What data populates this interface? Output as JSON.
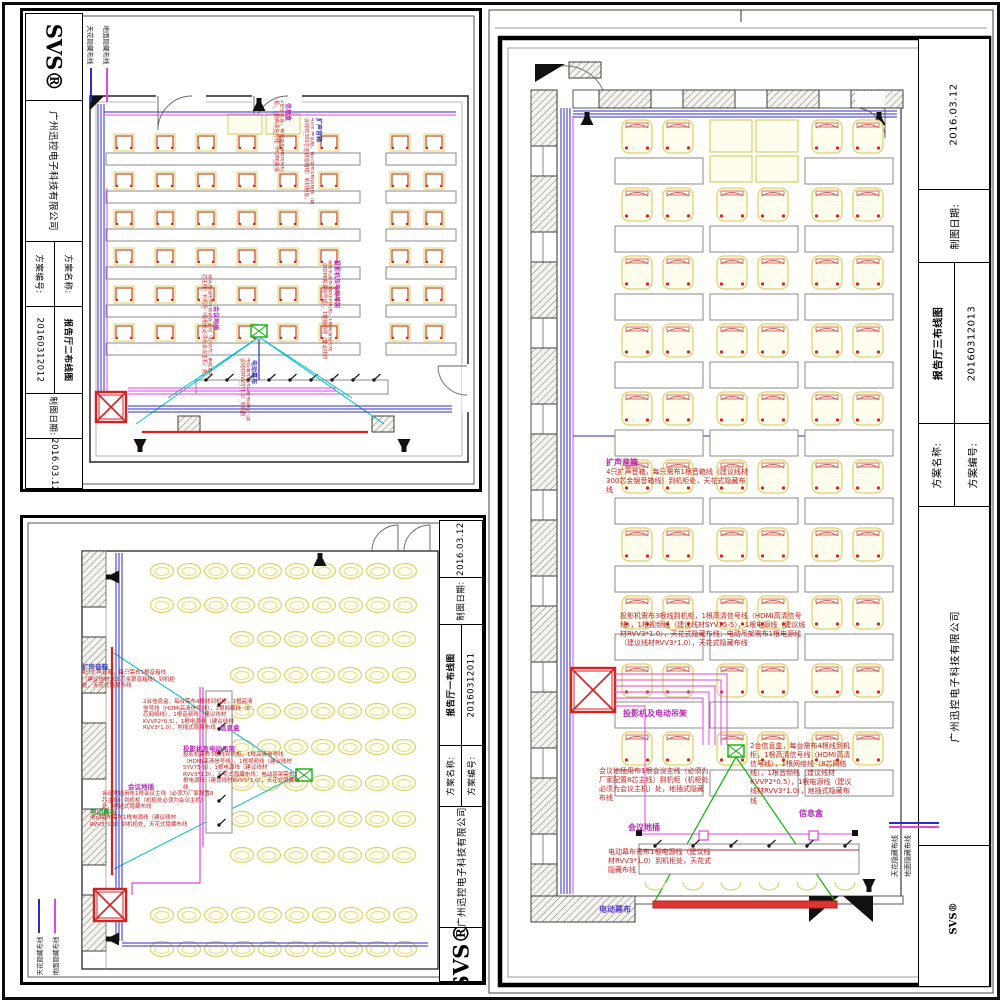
{
  "branding": {
    "logo": "SVS®",
    "company": "广州迅控电子科技有限公司"
  },
  "titleblock": {
    "name_label": "方案名称:",
    "number_label": "方案编号:",
    "date_label": "制图日期:",
    "date": "2016.03.12"
  },
  "legend": {
    "ceiling_label": "天花隐藏布线",
    "floor_label": "地面隐藏布线",
    "ceiling_color": "#2b2bc8",
    "floor_color": "#e046e0"
  },
  "sheets": [
    {
      "id": "hall2",
      "title": "报告厅二布线图",
      "number": "20160312012"
    },
    {
      "id": "hall1",
      "title": "报告厅一布线图",
      "number": "20160312011"
    },
    {
      "id": "hall3",
      "title": "报告厅三布线图",
      "number": "20160312013"
    }
  ],
  "annotations": {
    "speaker_label": "扩声音箱",
    "speaker_text": "4只扩声音箱，每只需布1根音箱线（建议线材300芯金银音箱线）到机柜处，天花式隐藏布线",
    "projector_label": "投影机及电动吊架",
    "projector_text": "投影机需布3根线到机柜，1根高清信号线（HDMI高清信号线），1根视频线（建议线材SYV75-5），1根电源线（建议线材RVV3*1.0），天花式隐藏布线；电动吊架需布1根电源线（建议线材RVV3*1.0），天花式隐藏布线",
    "infobox_label": "信息盒",
    "infobox_text": "2台信息盒，每台需布4根线到机柜，1根高清信号线（HDMI高清信号线），1根网络线（8芯网络线），1根音频线（建议线材KVVP2*0.5），1根电源线（建议线材RVV3*1.0），地插式隐藏布线",
    "conference_label": "会议地插",
    "conference_text": "会议地插用布1根会议主线（必须为厂家配置8芯主线）到机柜（机柜处必须为会议主机）处，地插式隐藏布线",
    "screen_label": "电动幕布",
    "screen_text": "电动幕布需布1根电源线（建议线材RVV3*1.0）到机柜处，天花式隐藏布线"
  }
}
